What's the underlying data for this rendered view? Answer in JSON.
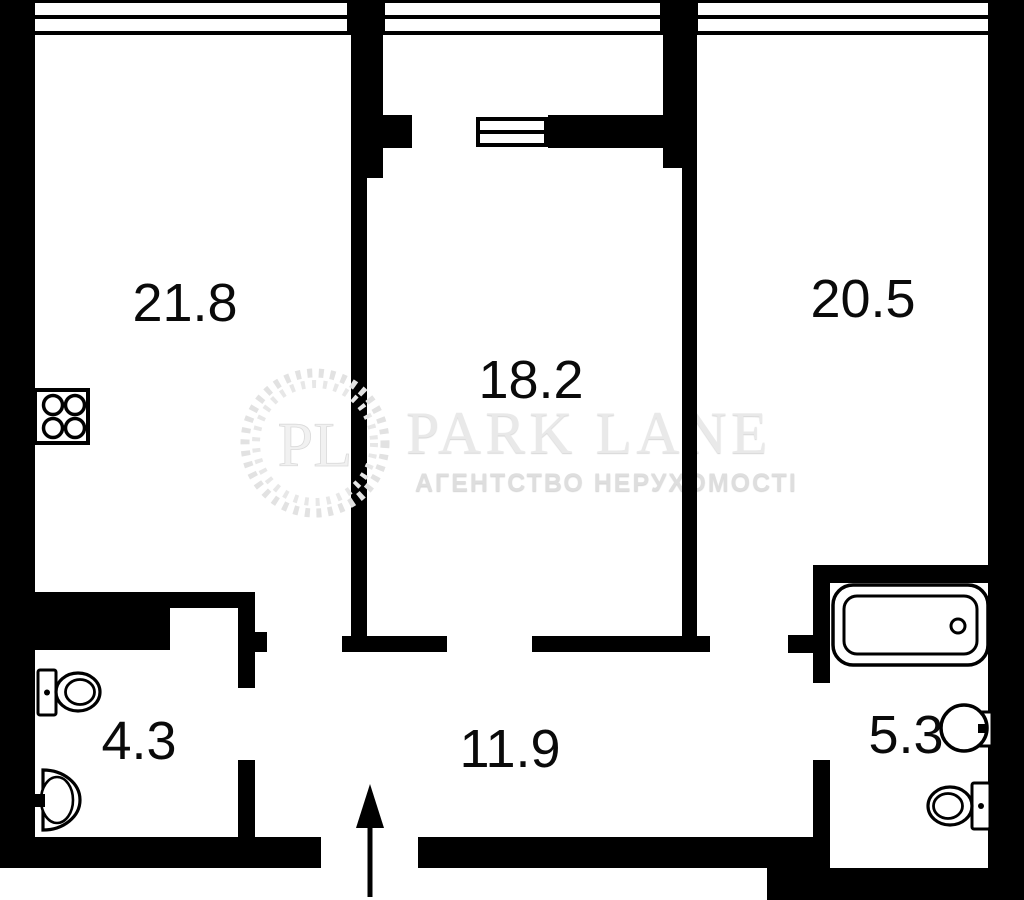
{
  "plan": {
    "rooms": [
      {
        "name": "room-top-left",
        "area": "21.8"
      },
      {
        "name": "room-center",
        "area": "18.2"
      },
      {
        "name": "room-top-right",
        "area": "20.5"
      },
      {
        "name": "wc-small",
        "area": "4.3"
      },
      {
        "name": "hallway",
        "area": "11.9"
      },
      {
        "name": "bathroom",
        "area": "5.3"
      }
    ],
    "watermark": {
      "logo_initials": "PL",
      "brand": "PARK LANE",
      "tagline": "АГЕНТСТВО НЕРУХОМОСТІ"
    },
    "colors": {
      "wall": "#000000",
      "floor": "#ffffff",
      "label": "#0a0a0a",
      "watermark_wreath": "#e2e2e2",
      "watermark_brand": "#e9e9e9",
      "watermark_tagline": "#dedede"
    }
  }
}
